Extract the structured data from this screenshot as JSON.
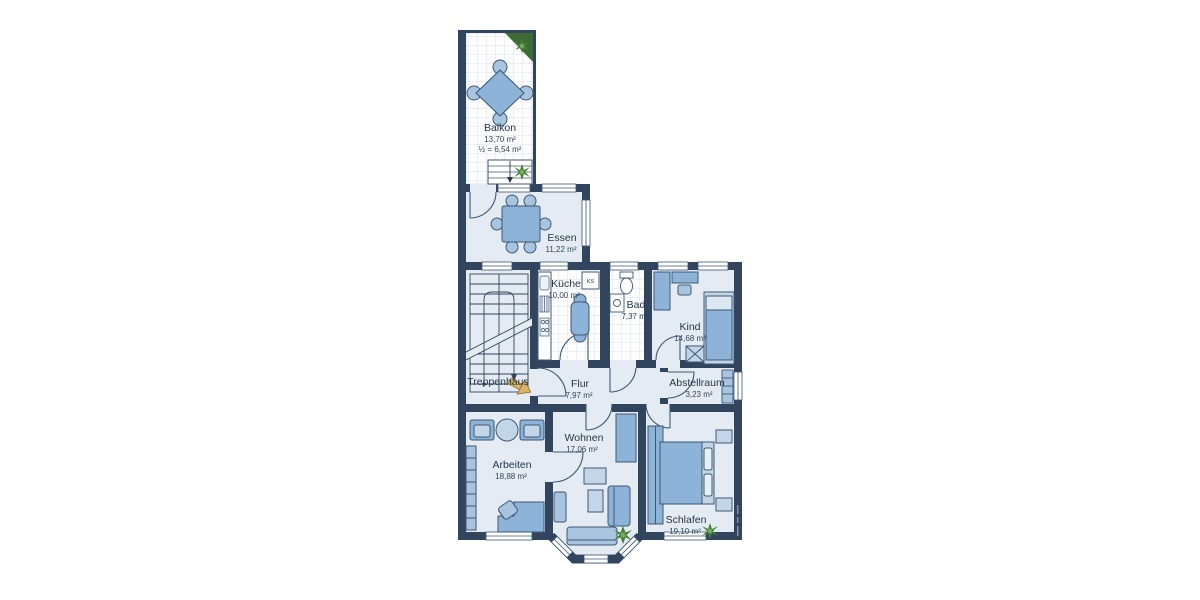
{
  "plan": {
    "type": "apartment-floor-plan",
    "rooms": {
      "balkon": {
        "name": "Balkon",
        "area": "13,70 m²",
        "area_half": "½ = 6,54 m²"
      },
      "essen": {
        "name": "Essen",
        "area": "11,22 m²"
      },
      "kueche": {
        "name": "Küche",
        "area": "10,00 m²"
      },
      "bad": {
        "name": "Bad",
        "area": "7,37 m²"
      },
      "kind": {
        "name": "Kind",
        "area": "14,68 m²"
      },
      "treppenhaus": {
        "name": "Treppenhaus"
      },
      "flur": {
        "name": "Flur",
        "area": "7,97 m²"
      },
      "abstellraum": {
        "name": "Abstellraum",
        "area": "3,23 m²"
      },
      "arbeiten": {
        "name": "Arbeiten",
        "area": "18,88 m²"
      },
      "wohnen": {
        "name": "Wohnen",
        "area": "17,06 m²"
      },
      "schlafen": {
        "name": "Schlafen",
        "area": "19,10 m²"
      }
    },
    "labels": {
      "fridge": "KS"
    },
    "colors": {
      "wall": "#31455e",
      "room_floor": "#e4ebf2",
      "tile_floor": "#fdfdfe",
      "tile_grid": "#d9e2ec",
      "furniture": "#8db3d8",
      "furniture_light": "#c3d6e8",
      "furniture_mid": "#a9c4de",
      "outline": "#3c5875",
      "plant_dark": "#49803c",
      "plant_light": "#76ad5a",
      "entrance_arrow": "#d9b264",
      "text": "#26374b"
    }
  }
}
